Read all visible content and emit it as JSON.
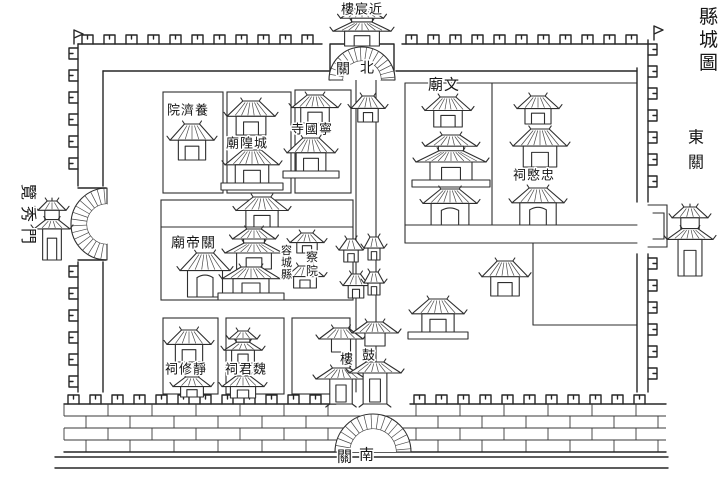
{
  "map": {
    "title": "縣城圖",
    "county": "容城縣",
    "ink_color": "#2e2e2e",
    "paper_color": "#ffffff"
  },
  "texts": [
    {
      "name": "map-title",
      "reading": "縣城圖",
      "chars": [
        "縣",
        "城",
        "圖"
      ],
      "dir": "v",
      "x": 699,
      "y": 6,
      "size": 19,
      "gap": 4
    },
    {
      "name": "east-suburb-label",
      "reading": "東關",
      "chars": [
        "東",
        "關"
      ],
      "dir": "v",
      "x": 688,
      "y": 128,
      "size": 16,
      "gap": 9
    },
    {
      "name": "west-gate-label",
      "reading": "覽秀門",
      "chars": [
        "覽",
        "秀",
        "門"
      ],
      "dir": "r90",
      "x": 21,
      "y": 184,
      "size": 16,
      "gap": 6
    },
    {
      "name": "north-tower-label",
      "reading": "近宸樓",
      "chars": [
        "樓",
        "宸",
        "近"
      ],
      "dir": "h",
      "x": 341,
      "y": 2,
      "size": 13
    },
    {
      "name": "north-gate-label-west-char",
      "reading": "北關",
      "chars": [
        "關"
      ],
      "dir": "h",
      "x": 336,
      "y": 61,
      "size": 14
    },
    {
      "name": "north-gate-label-east-char",
      "reading": "北關",
      "chars": [
        "北"
      ],
      "dir": "h",
      "x": 360,
      "y": 60,
      "size": 14
    },
    {
      "name": "yangjiyuan-label",
      "reading": "養濟院",
      "chars": [
        "院",
        "濟",
        "養"
      ],
      "dir": "h",
      "x": 167,
      "y": 103,
      "size": 13
    },
    {
      "name": "chenghuangmiao-label",
      "reading": "城隍廟",
      "chars": [
        "廟",
        "隍",
        "城"
      ],
      "dir": "h",
      "x": 226,
      "y": 136,
      "size": 13
    },
    {
      "name": "ningguosi-label",
      "reading": "寧國寺",
      "chars": [
        "寺",
        "國",
        "寧"
      ],
      "dir": "h",
      "x": 291,
      "y": 122,
      "size": 13
    },
    {
      "name": "guandimiao-label",
      "reading": "關帝廟",
      "chars": [
        "廟",
        "帝",
        "關"
      ],
      "dir": "h",
      "x": 171,
      "y": 235,
      "size": 14
    },
    {
      "name": "rongcheng-county-label",
      "reading": "容城縣",
      "chars": [
        "容",
        "城",
        "縣"
      ],
      "dir": "v",
      "x": 281,
      "y": 244,
      "size": 11,
      "gap": 1
    },
    {
      "name": "chayuan-label",
      "reading": "察院",
      "chars": [
        "察",
        "院"
      ],
      "dir": "v",
      "x": 306,
      "y": 250,
      "size": 12,
      "gap": 2
    },
    {
      "name": "wenmiao-label",
      "reading": "文廟",
      "chars": [
        "廟",
        "文"
      ],
      "dir": "h",
      "x": 428,
      "y": 76,
      "size": 15
    },
    {
      "name": "zhongminci-label",
      "reading": "忠愍祠",
      "chars": [
        "祠",
        "愍",
        "忠"
      ],
      "dir": "h",
      "x": 513,
      "y": 168,
      "size": 13
    },
    {
      "name": "jingxiuci-label",
      "reading": "靜修祠",
      "chars": [
        "祠",
        "修",
        "靜"
      ],
      "dir": "h",
      "x": 165,
      "y": 362,
      "size": 13
    },
    {
      "name": "weijunci-label",
      "reading": "魏君祠",
      "chars": [
        "祠",
        "君",
        "魏"
      ],
      "dir": "h",
      "x": 225,
      "y": 362,
      "size": 13
    },
    {
      "name": "drum-tower-label-west-char",
      "reading": "鼓樓",
      "chars": [
        "樓"
      ],
      "dir": "h",
      "x": 340,
      "y": 352,
      "size": 13
    },
    {
      "name": "drum-tower-label-east-char",
      "reading": "鼓樓",
      "chars": [
        "鼓"
      ],
      "dir": "h",
      "x": 362,
      "y": 348,
      "size": 13
    },
    {
      "name": "south-gate-label-west-char",
      "reading": "南關",
      "chars": [
        "關"
      ],
      "dir": "h",
      "x": 337,
      "y": 448,
      "size": 15
    },
    {
      "name": "south-gate-label-east-char",
      "reading": "南關",
      "chars": [
        "南"
      ],
      "dir": "h",
      "x": 359,
      "y": 446,
      "size": 15
    }
  ],
  "buildings": [
    {
      "name": "north-gate-tower",
      "kind": "hall2",
      "x": 362,
      "y": 9,
      "w": 58,
      "h": 37
    },
    {
      "name": "yangjiyuan-hall",
      "kind": "hall",
      "x": 192,
      "y": 124,
      "w": 44,
      "h": 36
    },
    {
      "name": "chenghuangmiao-upper-hall",
      "kind": "hall",
      "x": 251,
      "y": 101,
      "w": 48,
      "h": 34
    },
    {
      "name": "chenghuangmiao-lower-hall",
      "kind": "basehall",
      "x": 252,
      "y": 150,
      "w": 54,
      "h": 40
    },
    {
      "name": "ningguosi-upper-hall",
      "kind": "hall",
      "x": 315,
      "y": 95,
      "w": 46,
      "h": 28
    },
    {
      "name": "ningguosi-lower-hall",
      "kind": "basehall",
      "x": 311,
      "y": 138,
      "w": 48,
      "h": 40
    },
    {
      "name": "guandimiao-gate-hall",
      "kind": "hall",
      "x": 262,
      "y": 197,
      "w": 52,
      "h": 30
    },
    {
      "name": "guandimiao-hall",
      "kind": "gatehall",
      "x": 205,
      "y": 253,
      "w": 50,
      "h": 44
    },
    {
      "name": "yamen-main-hall",
      "kind": "hall2",
      "x": 254,
      "y": 229,
      "w": 58,
      "h": 40
    },
    {
      "name": "yamen-second-hall",
      "kind": "basehall",
      "x": 251,
      "y": 267,
      "w": 58,
      "h": 33
    },
    {
      "name": "chayuan-upper-hall",
      "kind": "small",
      "x": 307,
      "y": 233,
      "w": 34,
      "h": 20
    },
    {
      "name": "chayuan-lower-hall",
      "kind": "small",
      "x": 305,
      "y": 266,
      "w": 38,
      "h": 22
    },
    {
      "name": "street-pavilion-north",
      "kind": "small",
      "x": 368,
      "y": 96,
      "w": 34,
      "h": 26
    },
    {
      "name": "street-pavilion-1",
      "kind": "small",
      "x": 351,
      "y": 239,
      "w": 24,
      "h": 23
    },
    {
      "name": "street-pavilion-2",
      "kind": "small",
      "x": 374,
      "y": 237,
      "w": 20,
      "h": 23
    },
    {
      "name": "street-pavilion-3",
      "kind": "small",
      "x": 356,
      "y": 274,
      "w": 26,
      "h": 24
    },
    {
      "name": "street-pavilion-4",
      "kind": "small",
      "x": 374,
      "y": 272,
      "w": 20,
      "h": 23
    },
    {
      "name": "drum-tower-west-half",
      "kind": "tower2",
      "x": 341,
      "y": 328,
      "w": 34,
      "h": 76
    },
    {
      "name": "drum-tower-east-half",
      "kind": "tower2",
      "x": 375,
      "y": 322,
      "w": 36,
      "h": 82
    },
    {
      "name": "wenmiao-upper-hall",
      "kind": "hall",
      "x": 448,
      "y": 97,
      "w": 46,
      "h": 30
    },
    {
      "name": "wenmiao-main-hall",
      "kind": "hall2base",
      "x": 451,
      "y": 135,
      "w": 70,
      "h": 52
    },
    {
      "name": "wenmiao-gate",
      "kind": "gatehall",
      "x": 450,
      "y": 189,
      "w": 54,
      "h": 36
    },
    {
      "name": "zhongminci-upper-hall",
      "kind": "hall",
      "x": 538,
      "y": 96,
      "w": 42,
      "h": 28
    },
    {
      "name": "zhongminci-main-hall",
      "kind": "hall",
      "x": 540,
      "y": 129,
      "w": 54,
      "h": 38
    },
    {
      "name": "zhongminci-gate",
      "kind": "gatehall",
      "x": 538,
      "y": 188,
      "w": 52,
      "h": 37
    },
    {
      "name": "southeast-hall-upper",
      "kind": "hall",
      "x": 505,
      "y": 261,
      "w": 46,
      "h": 35
    },
    {
      "name": "southeast-hall-lower",
      "kind": "basehall",
      "x": 438,
      "y": 299,
      "w": 52,
      "h": 40
    },
    {
      "name": "jingxiuci-upper-hall",
      "kind": "hall",
      "x": 189,
      "y": 330,
      "w": 44,
      "h": 32
    },
    {
      "name": "jingxiuci-lower-hall",
      "kind": "small",
      "x": 192,
      "y": 377,
      "w": 38,
      "h": 20
    },
    {
      "name": "weijunci-upper-hall",
      "kind": "hall2",
      "x": 243,
      "y": 331,
      "w": 38,
      "h": 32
    },
    {
      "name": "weijunci-lower-hall",
      "kind": "small",
      "x": 243,
      "y": 376,
      "w": 42,
      "h": 22
    },
    {
      "name": "west-gate-tower",
      "kind": "tower",
      "x": 52,
      "y": 198,
      "w": 36,
      "h": 62
    },
    {
      "name": "east-gate-tower",
      "kind": "tower",
      "x": 690,
      "y": 204,
      "w": 46,
      "h": 72
    }
  ],
  "plan": {
    "rects": [
      [
        163,
        92,
        60,
        101
      ],
      [
        227,
        92,
        64,
        101
      ],
      [
        295,
        90,
        56,
        103
      ],
      [
        161,
        200,
        192,
        100
      ],
      [
        163,
        318,
        55,
        76
      ],
      [
        226,
        318,
        58,
        76
      ],
      [
        292,
        318,
        58,
        76
      ]
    ],
    "lines": [
      [
        161,
        227,
        353,
        227
      ],
      [
        405,
        83,
        637,
        83
      ],
      [
        405,
        83,
        405,
        243
      ],
      [
        492,
        83,
        492,
        225
      ],
      [
        405,
        225,
        637,
        225
      ],
      [
        405,
        243,
        637,
        243
      ],
      [
        533,
        243,
        533,
        325
      ],
      [
        533,
        325,
        637,
        325
      ],
      [
        356,
        80,
        356,
        392
      ],
      [
        376,
        80,
        376,
        392
      ]
    ]
  }
}
